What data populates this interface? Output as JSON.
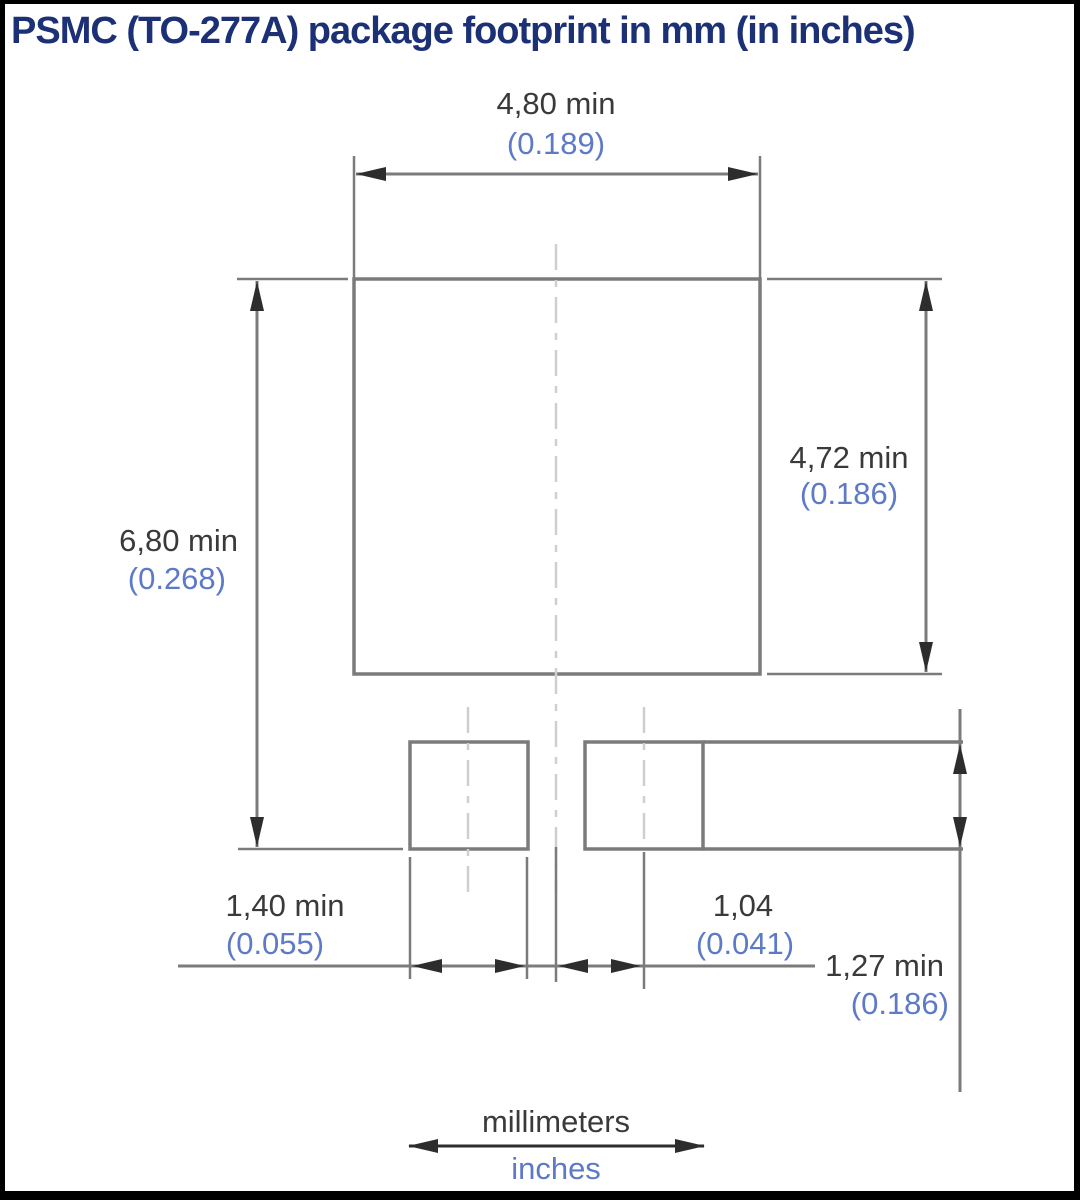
{
  "title": "PSMC (TO-277A) package footprint in mm (in inches)",
  "dimensions": {
    "top_width": {
      "mm": "4,80 min",
      "in": "(0.189)"
    },
    "right_height": {
      "mm": "4,72 min",
      "in": "(0.186)"
    },
    "left_height": {
      "mm": "6,80 min",
      "in": "(0.268)"
    },
    "pad_width": {
      "mm": "1,40 min",
      "in": "(0.055)"
    },
    "pad_center_offset": {
      "mm": "1,04",
      "in": "(0.041)"
    },
    "pad_height": {
      "mm": "1,27 min",
      "in": "(0.186)"
    }
  },
  "legend": {
    "mm": "millimeters",
    "in": "inches"
  },
  "colors": {
    "navy": "#1c3076",
    "ink": "#3a3a3a",
    "blue": "#5d7ac8",
    "line": "#7b7b7b",
    "faint": "#cfcfcf",
    "arrow": "#2d2d2d",
    "border": "#000000",
    "background": "#ffffff"
  }
}
